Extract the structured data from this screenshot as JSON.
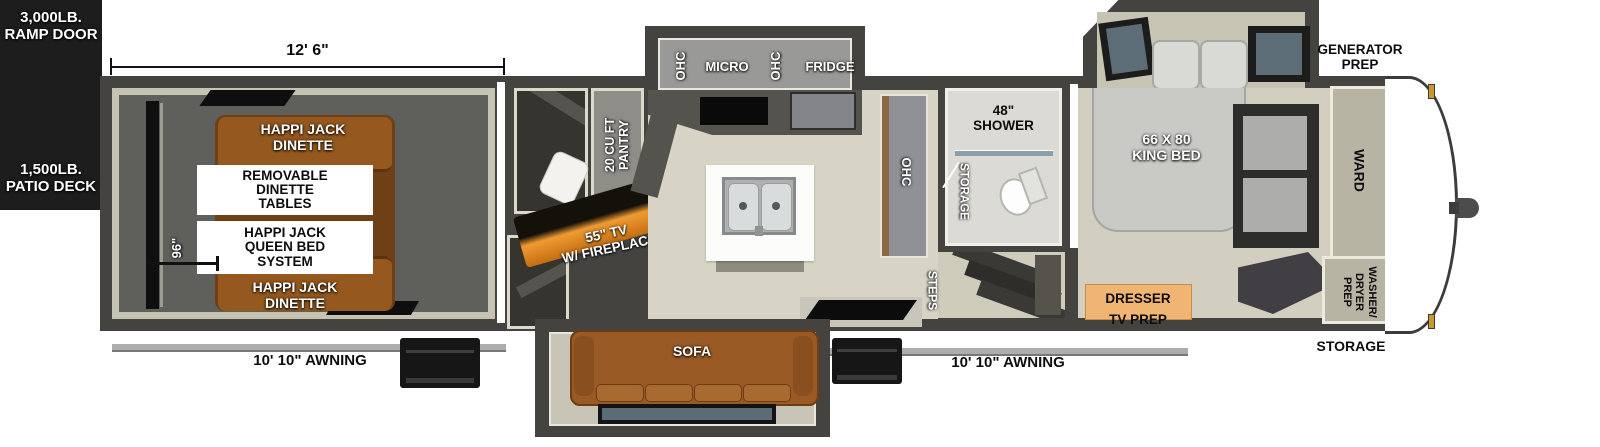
{
  "fp": {
    "title_note": "fifth-wheel toy hauler floor plan",
    "exterior": {
      "ramp_door": "3,000LB.\nRAMP DOOR",
      "patio_deck": "1,500LB.\nPATIO DECK",
      "generator_prep": "GENERATOR\nPREP",
      "storage_front": "STORAGE",
      "awning_left": "10' 10\" AWNING",
      "awning_right": "10' 10\" AWNING"
    },
    "dimensions": {
      "garage_length": "12' 6\"",
      "garage_width": "96\""
    },
    "garage": {
      "dinette_top": "HAPPI JACK\nDINETTE",
      "dinette_bottom": "HAPPI JACK\nDINETTE",
      "removable_tables": "REMOVABLE\nDINETTE\nTABLES",
      "queen_bed_system": "HAPPI JACK\nQUEEN BED\nSYSTEM"
    },
    "living": {
      "pantry": "20 CU FT\nPANTRY",
      "tv_fireplace": "55\" TV\nW/ FIREPLACE",
      "ohc_upper_left": "OHC",
      "micro": "MICRO",
      "ohc_upper_mid": "OHC",
      "fridge": "FRIDGE",
      "ohc_wall": "OHC",
      "sofa": "SOFA",
      "steps": "STEPS"
    },
    "bathroom": {
      "shower": "48\"\nSHOWER",
      "storage": "STORAGE"
    },
    "bedroom": {
      "king_bed": "66 X 80\nKING BED",
      "dresser_tv_prep": "DRESSER\nTV PREP",
      "ward": "WARD",
      "washer_dryer_prep": "WASHER/\nDRYER\nPREP"
    },
    "colors": {
      "wall": "#454340",
      "floor_tan": "#d8d4c5",
      "garage_floor": "#5f5f5c",
      "sofa_brown": "#9a5a26",
      "dresser_orange": "#f0b473",
      "fireplace_glow": "#ef9a31",
      "black_box": "#1d1d1d"
    }
  }
}
